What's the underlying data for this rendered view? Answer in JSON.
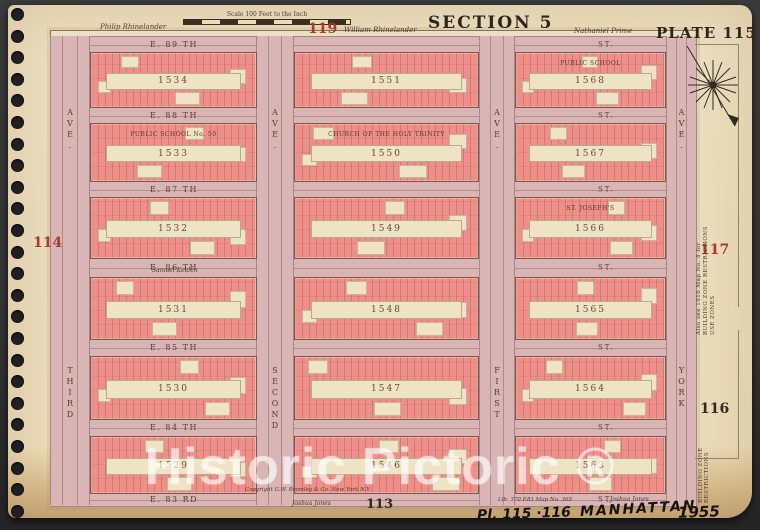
{
  "plate": {
    "section": "SECTION 5",
    "plate": "PLATE 115",
    "scale_note": "Scale 100 Feet to the Inch",
    "adjacent_plates": {
      "top": "119",
      "left": "114",
      "right_upper": "117",
      "right_lower": "116",
      "bottom": "113"
    }
  },
  "owners": {
    "top_left": "Philip Rhinelander",
    "top_center": "William Rhinelander",
    "top_right": "Nathaniel Prime",
    "mid_left": "Samuel Kelden",
    "bottom": "Joshua Jones"
  },
  "streets": [
    {
      "label": "E. 89 TH",
      "suffix": "ST."
    },
    {
      "label": "E. 88 TH",
      "suffix": "ST."
    },
    {
      "label": "E. 87 TH",
      "suffix": "ST."
    },
    {
      "label": "E. 86 TH",
      "suffix": "ST."
    },
    {
      "label": "E. 85 TH",
      "suffix": "ST."
    },
    {
      "label": "E. 84 TH",
      "suffix": "ST."
    },
    {
      "label": "E. 83 RD",
      "suffix": "ST."
    }
  ],
  "avenues": [
    {
      "name": "THIRD",
      "word": "AVE."
    },
    {
      "name": "SECOND",
      "word": "AVE."
    },
    {
      "name": "FIRST",
      "word": "AVE."
    },
    {
      "name": "YORK",
      "word": "AVE."
    }
  ],
  "blocks": {
    "rows": [
      {
        "cells": [
          {
            "number": "1534"
          },
          {
            "number": "1551"
          },
          {
            "number": "1568",
            "landmark": "PUBLIC SCHOOL"
          }
        ]
      },
      {
        "cells": [
          {
            "number": "1533",
            "landmark": "PUBLIC SCHOOL No. 50"
          },
          {
            "number": "1550",
            "landmark": "CHURCH OF THE HOLY TRINITY"
          },
          {
            "number": "1567"
          }
        ]
      },
      {
        "cells": [
          {
            "number": "1532"
          },
          {
            "number": "1549"
          },
          {
            "number": "1566",
            "landmark": "ST. JOSEPH'S"
          }
        ]
      },
      {
        "cells": [
          {
            "number": "1531"
          },
          {
            "number": "1548"
          },
          {
            "number": "1565"
          }
        ]
      },
      {
        "cells": [
          {
            "number": "1530"
          },
          {
            "number": "1547"
          },
          {
            "number": "1564"
          }
        ]
      },
      {
        "cells": [
          {
            "number": "1529"
          },
          {
            "number": "1546"
          },
          {
            "number": "1563"
          }
        ]
      }
    ]
  },
  "notes": {
    "copyright": "Copyright G.W. Bromley & Co. New York N.Y.",
    "map_ref": "Lib. 370 P.81 Map No. 368",
    "zone_note_1": "Also see 1916 Map No. 8 for",
    "zone_note_2": "BUILDING ZONE RESTRICTIONS",
    "zone_note_3": "USE ZONES"
  },
  "photo": {
    "watermark": "Historic Pictoric ®",
    "handwriting": {
      "plates": "Pl. 115 ∙116",
      "borough": "MANHATTAN",
      "year": "1955"
    }
  }
}
